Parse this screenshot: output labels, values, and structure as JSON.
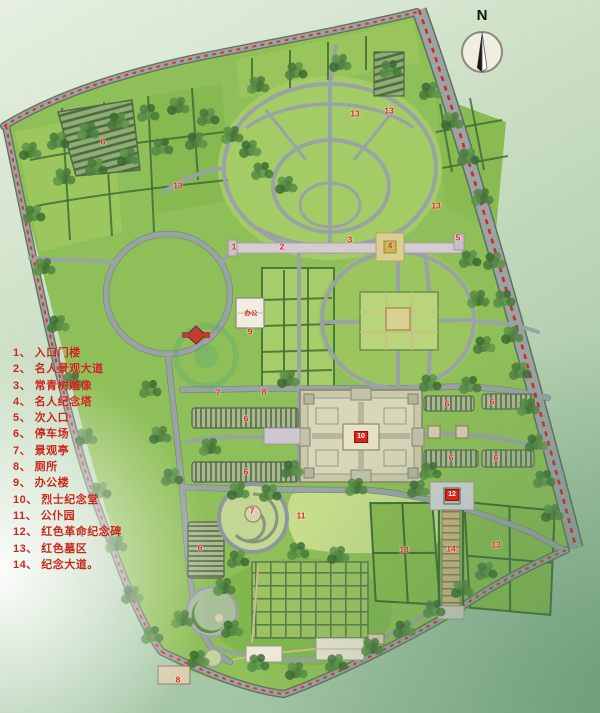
{
  "page": {
    "type": "memorial-park-master-plan"
  },
  "north": {
    "label": "N"
  },
  "legend": {
    "items": [
      {
        "num": "1",
        "label": "入口门楼"
      },
      {
        "num": "2",
        "label": "名人景观大道"
      },
      {
        "num": "3",
        "label": "常青树雕像"
      },
      {
        "num": "4",
        "label": "名人纪念塔"
      },
      {
        "num": "5",
        "label": "次入口"
      },
      {
        "num": "6",
        "label": "停车场"
      },
      {
        "num": "7",
        "label": "景观亭"
      },
      {
        "num": "8",
        "label": "厕所"
      },
      {
        "num": "9",
        "label": "办公楼"
      },
      {
        "num": "10",
        "label": "烈士纪念堂"
      },
      {
        "num": "11",
        "label": "公仆园"
      },
      {
        "num": "12",
        "label": "红色革命纪念碑"
      },
      {
        "num": "13",
        "label": "红色墓区"
      },
      {
        "num": "14",
        "label": "纪念大道。"
      }
    ]
  },
  "map_labels": {
    "office": "办公"
  },
  "markers": [
    {
      "n": "6",
      "x": 103,
      "y": 142
    },
    {
      "n": "13",
      "x": 178,
      "y": 186
    },
    {
      "n": "13",
      "x": 355,
      "y": 114
    },
    {
      "n": "13",
      "x": 389,
      "y": 111
    },
    {
      "n": "13",
      "x": 436,
      "y": 206
    },
    {
      "n": "1",
      "x": 234,
      "y": 247
    },
    {
      "n": "2",
      "x": 282,
      "y": 247
    },
    {
      "n": "3",
      "x": 350,
      "y": 240
    },
    {
      "n": "4",
      "x": 390,
      "y": 246
    },
    {
      "n": "5",
      "x": 458,
      "y": 238
    },
    {
      "n": "9",
      "x": 250,
      "y": 332
    },
    {
      "n": "7",
      "x": 218,
      "y": 393
    },
    {
      "n": "8",
      "x": 264,
      "y": 392
    },
    {
      "n": "6",
      "x": 246,
      "y": 419
    },
    {
      "n": "6",
      "x": 246,
      "y": 472
    },
    {
      "n": "6",
      "x": 447,
      "y": 404
    },
    {
      "n": "6",
      "x": 492,
      "y": 402
    },
    {
      "n": "6",
      "x": 451,
      "y": 458
    },
    {
      "n": "6",
      "x": 496,
      "y": 458
    },
    {
      "n": "10",
      "x": 361,
      "y": 437,
      "box": true
    },
    {
      "n": "11",
      "x": 301,
      "y": 516
    },
    {
      "n": "7",
      "x": 252,
      "y": 511
    },
    {
      "n": "6",
      "x": 200,
      "y": 548
    },
    {
      "n": "12",
      "x": 452,
      "y": 495,
      "box": true
    },
    {
      "n": "14",
      "x": 451,
      "y": 549
    },
    {
      "n": "13",
      "x": 404,
      "y": 550
    },
    {
      "n": "13",
      "x": 496,
      "y": 545
    },
    {
      "n": "8",
      "x": 178,
      "y": 680
    }
  ],
  "colors": {
    "legend_text": "#c8281c",
    "marker_red": "#e02312",
    "boundary_dash": "#e23420",
    "road_gray": "#99a2a5",
    "site_green": "#8fbf58",
    "tree_green": "#47793a",
    "hall_tan": "#d9d7bb"
  }
}
